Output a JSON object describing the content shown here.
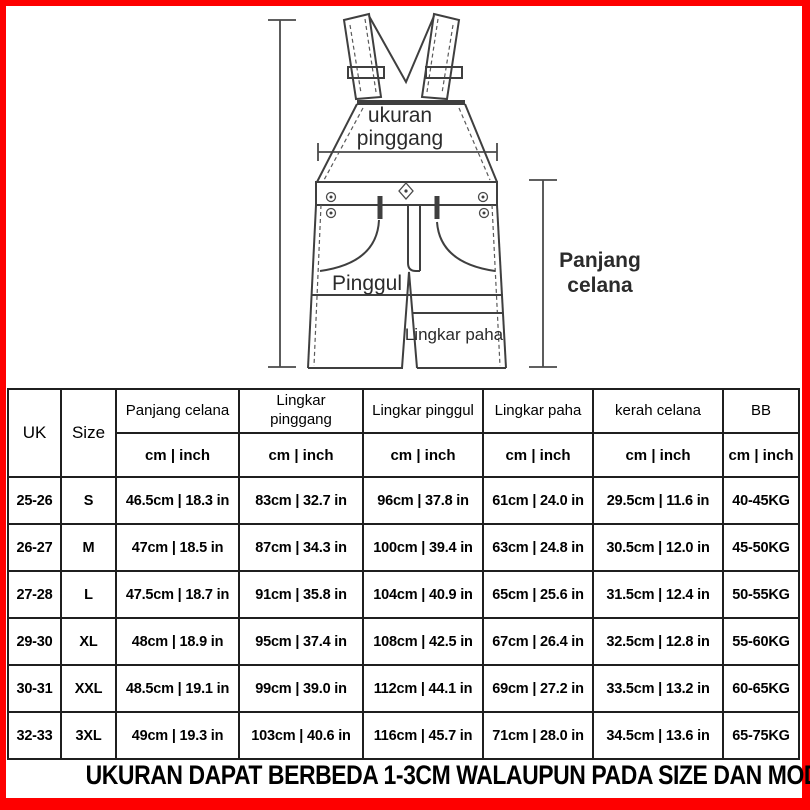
{
  "colors": {
    "border": "#fe0000",
    "line": "#3f3f3f",
    "text": "#000000"
  },
  "diagram": {
    "labels": {
      "waist_line1": "ukuran",
      "waist_line2": "pinggang",
      "hip": "Pinggul",
      "thigh": "Lingkar paha",
      "length_line1": "Panjang",
      "length_line2": "celana"
    }
  },
  "table": {
    "headers": {
      "uk": "UK",
      "size": "Size",
      "measures": [
        "Panjang celana",
        "Lingkar pinggang",
        "Lingkar pinggul",
        "Lingkar paha",
        "kerah celana",
        "BB"
      ],
      "unit": "cm | inch"
    },
    "rows": [
      {
        "uk": "25-26",
        "size": "S",
        "values": [
          "46.5cm | 18.3 in",
          "83cm | 32.7 in",
          "96cm | 37.8 in",
          "61cm | 24.0 in",
          "29.5cm | 11.6 in",
          "40-45KG"
        ]
      },
      {
        "uk": "26-27",
        "size": "M",
        "values": [
          "47cm | 18.5 in",
          "87cm | 34.3 in",
          "100cm | 39.4 in",
          "63cm | 24.8 in",
          "30.5cm | 12.0 in",
          "45-50KG"
        ]
      },
      {
        "uk": "27-28",
        "size": "L",
        "values": [
          "47.5cm | 18.7 in",
          "91cm | 35.8 in",
          "104cm | 40.9 in",
          "65cm | 25.6 in",
          "31.5cm | 12.4 in",
          "50-55KG"
        ]
      },
      {
        "uk": "29-30",
        "size": "XL",
        "values": [
          "48cm | 18.9 in",
          "95cm | 37.4 in",
          "108cm | 42.5 in",
          "67cm | 26.4 in",
          "32.5cm | 12.8 in",
          "55-60KG"
        ]
      },
      {
        "uk": "30-31",
        "size": "XXL",
        "values": [
          "48.5cm | 19.1 in",
          "99cm | 39.0 in",
          "112cm | 44.1 in",
          "69cm | 27.2 in",
          "33.5cm | 13.2 in",
          "60-65KG"
        ]
      },
      {
        "uk": "32-33",
        "size": "3XL",
        "values": [
          "49cm | 19.3 in",
          "103cm | 40.6 in",
          "116cm | 45.7 in",
          "71cm | 28.0 in",
          "34.5cm | 13.6 in",
          "65-75KG"
        ]
      }
    ]
  },
  "footer": {
    "note": "UKURAN DAPAT BERBEDA 1-3CM WALAUPUN PADA SIZE DAN MODEL YANG SAMA"
  }
}
